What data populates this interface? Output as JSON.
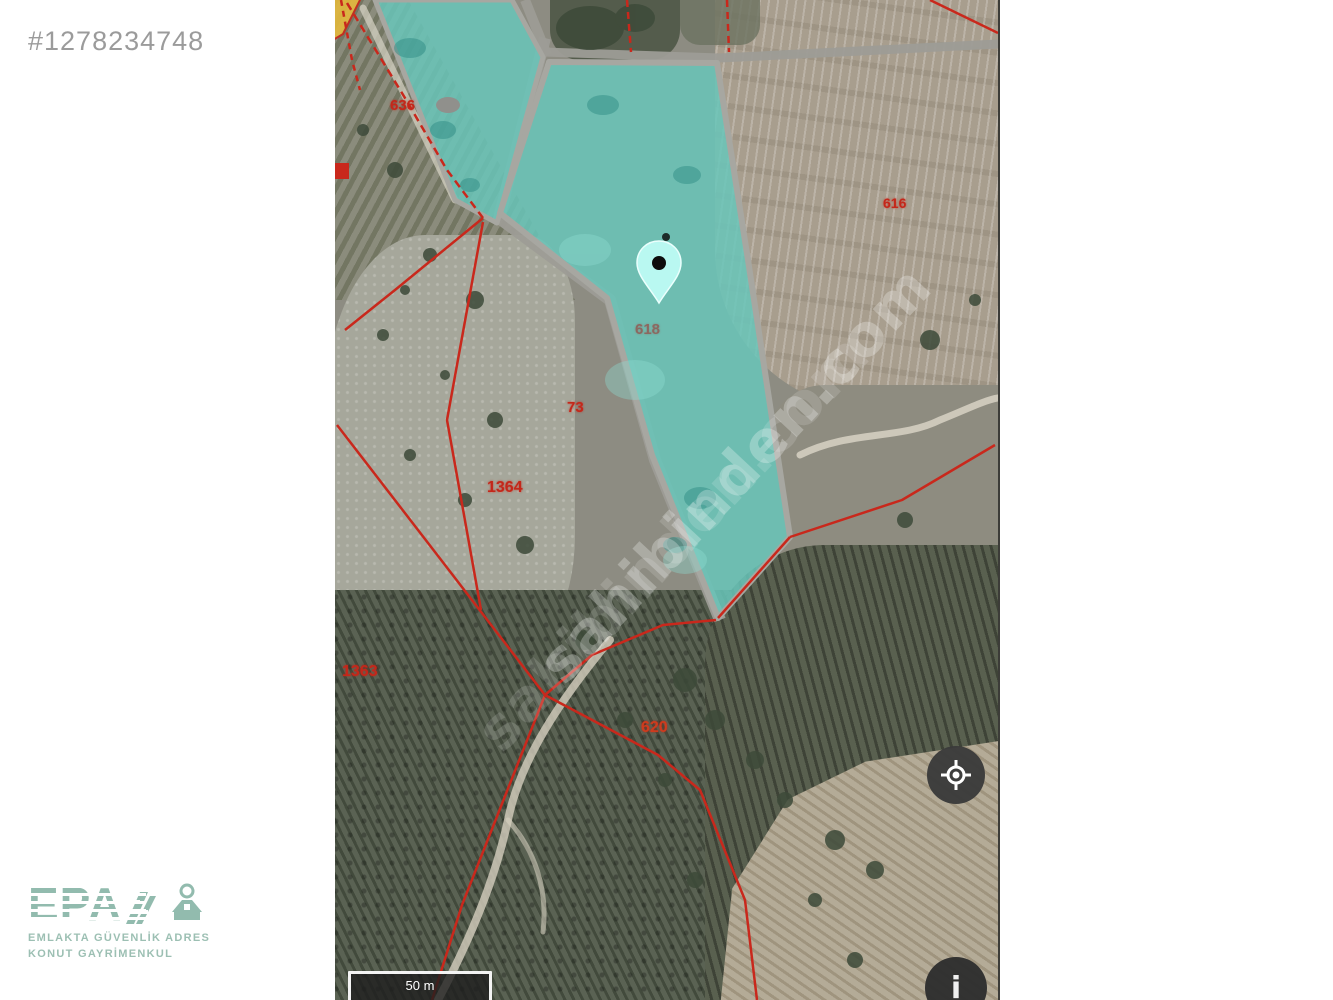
{
  "listing_id": "#1278234748",
  "logo": {
    "brand": "EPA",
    "tagline_line1": "EMLAKTA GÜVENLİK ADRES",
    "tagline_line2": "KONUT GAYRİMENKUL"
  },
  "map": {
    "watermark": "sahibinden.com",
    "scale_label": "50 m",
    "parcel_numbers": {
      "p636": "636",
      "p616": "616",
      "p618": "618",
      "p73": "73",
      "p1364": "1364",
      "p1363": "1363",
      "p620": "620"
    },
    "buttons": {
      "info": "i"
    },
    "colors": {
      "parcel_highlight": "#68c6ba",
      "cadastral_line": "#c9281c",
      "pin_fill": "#b9f8f1",
      "road": "#9d9c96"
    }
  }
}
